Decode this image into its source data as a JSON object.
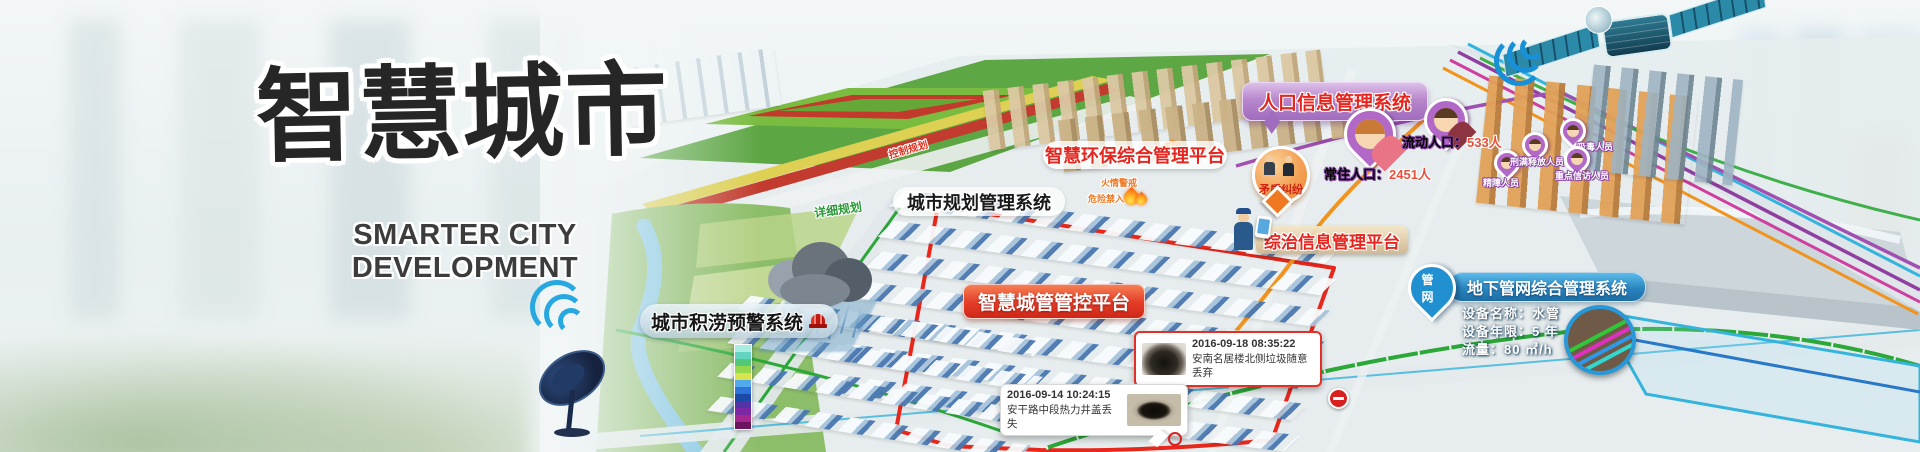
{
  "banner": {
    "title_cn": "智慧城市",
    "title_en": "SMARTER CITY DEVELOPMENT"
  },
  "system_labels": {
    "env": "智慧环保综合管理平台",
    "planning": "城市规划管理系统",
    "population": "人口信息管理系统",
    "zongzhi": "综治信息管理平台",
    "chengguan": "智慧城管管控平台",
    "pipe_network": "地下管网综合管理系统",
    "waterlog": "城市积涝预警系统"
  },
  "map_annotations": {
    "control_planning": "控制规划",
    "detailed_planning": "详细规划",
    "pipe_pin": "管网",
    "fire_alert": "火情警戒",
    "danger_no_entry": "危险禁入",
    "conflict": "矛盾纠纷"
  },
  "population_stats": {
    "floating": {
      "label": "流动人口：",
      "value": "533人"
    },
    "resident": {
      "label": "常住人口：",
      "value": "2451人"
    }
  },
  "person_tags": [
    "精障人员",
    "刑满释放人员",
    "吸毒人员",
    "重点信访人员"
  ],
  "pipe_details": {
    "name": "设备名称：水管",
    "age": "设备年限：5 年",
    "flow": "流量：80 ㎥/h"
  },
  "events": [
    {
      "time": "2016-09-18 08:35:22",
      "desc": "安南名居楼北侧垃圾随意丢弃"
    },
    {
      "time": "2016-09-14 10:24:15",
      "desc": "安干路中段热力井盖丢失"
    }
  ],
  "colors": {
    "label_red_text": "#e5261f",
    "chengguan_red": "#d5291b",
    "pipe_blue": "#1f72ab",
    "population_purple": "#a06cbe",
    "route_red": "#e8271c",
    "route_green": "#2ba838",
    "route_orange": "#f0941e",
    "route_purple": "#9040a0"
  }
}
